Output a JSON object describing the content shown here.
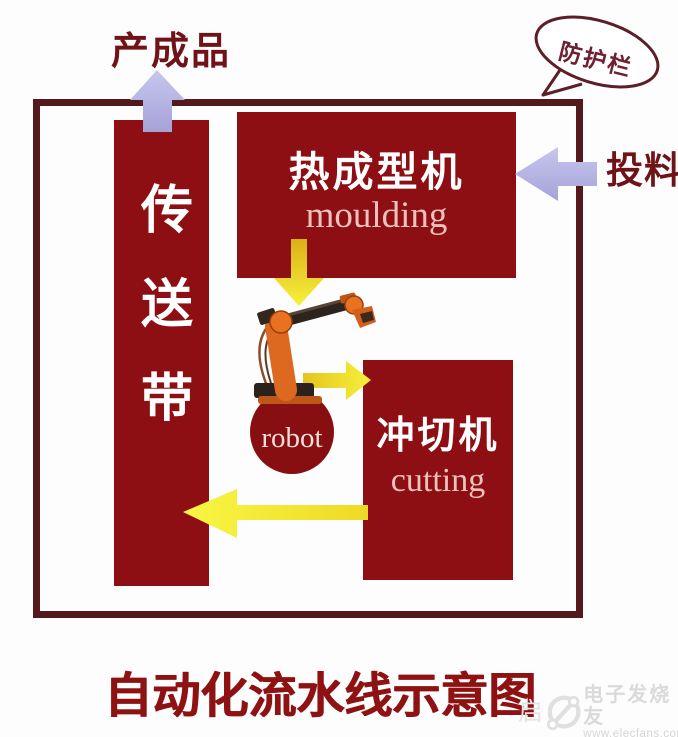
{
  "diagram": {
    "title": "自动化流水线示意图",
    "annotations": {
      "finished_product": "产成品",
      "feeding": "投料",
      "guardrail": "防护栏"
    },
    "nodes": {
      "conveyor": {
        "label": "传送带"
      },
      "moulding": {
        "name_zh": "热成型机",
        "name_en": "moulding"
      },
      "cutting": {
        "name_zh": "冲切机",
        "name_en": "cutting"
      },
      "robot": {
        "label": "robot"
      }
    },
    "flows": [
      {
        "from": "feeding",
        "to": "moulding",
        "arrow": "lavender-left"
      },
      {
        "from": "moulding",
        "to": "robot",
        "arrow": "yellow-down"
      },
      {
        "from": "robot",
        "to": "cutting",
        "arrow": "yellow-right"
      },
      {
        "from": "cutting",
        "to": "conveyor",
        "arrow": "yellow-left"
      },
      {
        "from": "conveyor",
        "to": "finished_product",
        "arrow": "lavender-up"
      }
    ],
    "colors": {
      "machine_block_red": "#8e0f13",
      "robot_circle_red": "#870f12",
      "fence_border": "#54191d",
      "annotation_red": "#701318",
      "title_red": "#8e1212",
      "arrow_yellow": "#f2e62e",
      "arrow_lavender": "#b1b0e0",
      "block_text_white": "#ffffff",
      "block_text_pink": "#eec2bc",
      "robot_orange": "#dd6820"
    }
  },
  "watermark": {
    "extra": "启",
    "brand": "电子发烧友",
    "url": "www.elecfans.com"
  }
}
